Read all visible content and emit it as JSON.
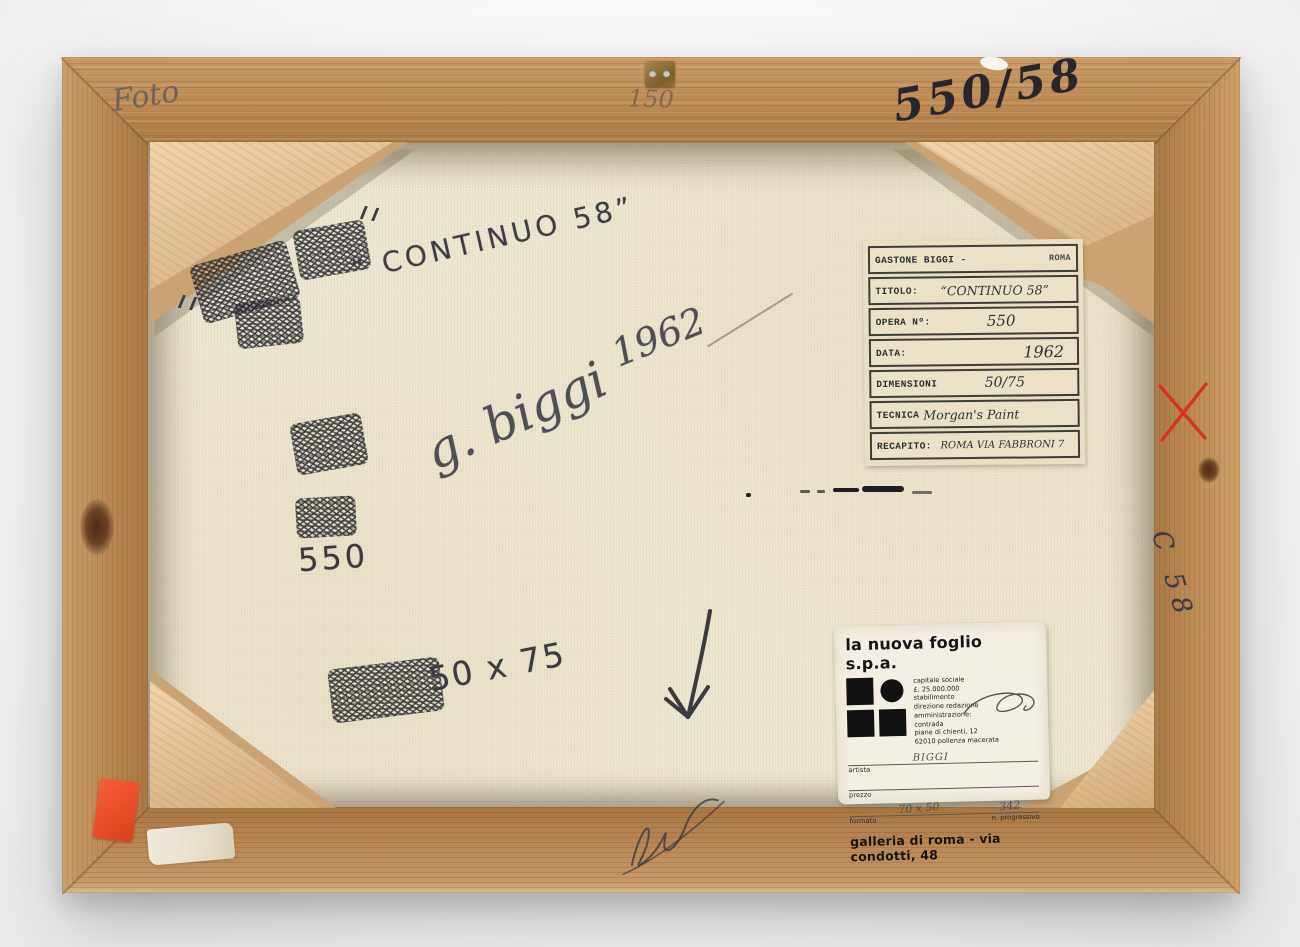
{
  "photo": {
    "subject": "Back of a framed painting on a white backdrop"
  },
  "frame_markings": {
    "foto": "Foto",
    "one_fifty": "150",
    "inventory_number": "550/58",
    "side_number": "C 58"
  },
  "canvas_markings": {
    "title_inscription": "“ CONTINUO 58”",
    "signature": "g. biggi",
    "year": "1962",
    "opera_number": "550",
    "dimensions": "50 x 75"
  },
  "typed_label": {
    "header_left": "GASTONE BIGGI -",
    "header_right": "ROMA",
    "rows": [
      {
        "label": "TITOLO:",
        "value": "“CONTINUO 58”"
      },
      {
        "label": "OPERA Nº:",
        "value": "550"
      },
      {
        "label": "DATA:",
        "value": "1962"
      },
      {
        "label": "DIMENSIONI",
        "value": "50/75"
      },
      {
        "label": "TECNICA",
        "value": "Morgan's Paint"
      },
      {
        "label": "RECAPITO:",
        "value": "ROMA VIA FABBRONI 7"
      }
    ]
  },
  "printed_label": {
    "company": "la nuova foglio s.p.a.",
    "details": [
      "capitale sociale",
      "£. 25.000.000",
      "stabilimento",
      "direzione redazione",
      "amministrazione:",
      "contrada",
      "piane di chienti, 12",
      "62010 pollenza macerata"
    ],
    "artista_label": "artista",
    "artista_value": "BIGGI",
    "prezzo_label": "prezzo",
    "formato_label": "formato",
    "formato_value": "70 x 50",
    "progressivo_label": "n. progressivo",
    "progressivo_value": "342",
    "footer": "galleria di roma - via condotti, 48"
  },
  "colors": {
    "wood": "#bd8a54",
    "canvas": "#ebe4d0",
    "pencil": "#4a4a52",
    "sticker_orange": "#ea4b28",
    "mark_red": "#d6341b"
  }
}
